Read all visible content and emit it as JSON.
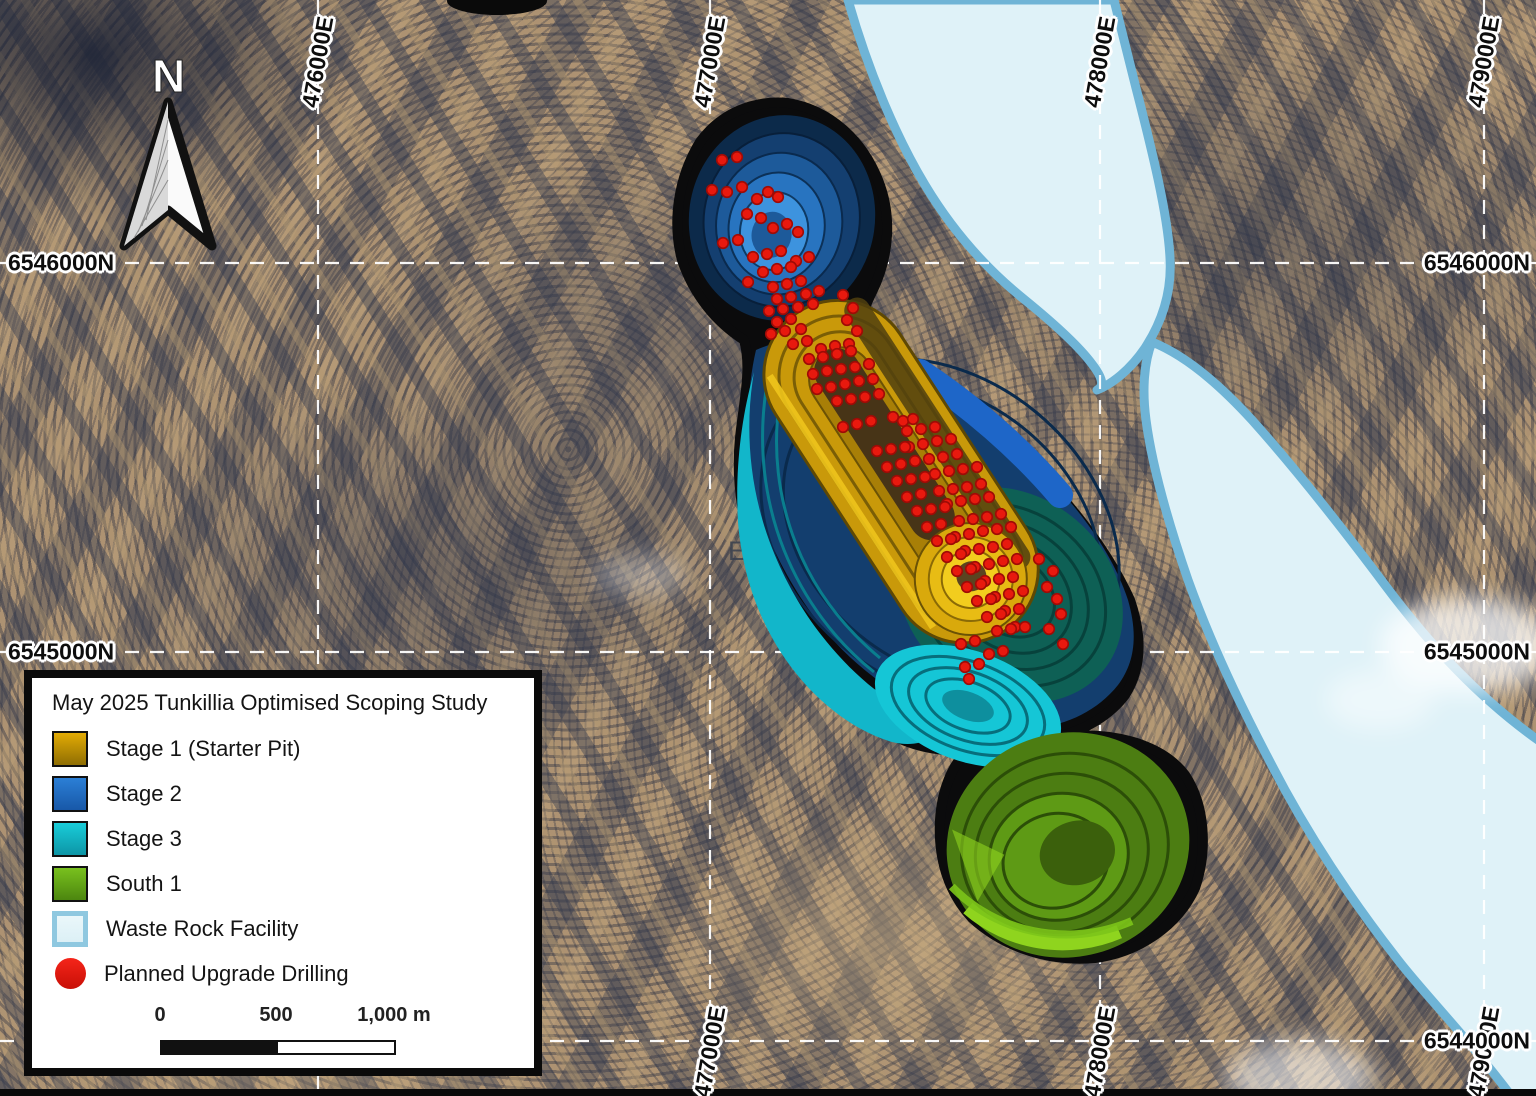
{
  "map": {
    "north_arrow_label": "N",
    "tenement_label": "EL 590",
    "grid": {
      "eastings": [
        {
          "label": "476000E",
          "x": 318,
          "top": true,
          "bottom": false
        },
        {
          "label": "477000E",
          "x": 710,
          "top": true,
          "bottom": true
        },
        {
          "label": "478000E",
          "x": 1100,
          "top": true,
          "bottom": true
        },
        {
          "label": "479000E",
          "x": 1484,
          "top": true,
          "bottom": true
        }
      ],
      "northings": [
        {
          "label": "6546000N",
          "y": 263,
          "left": true,
          "right": true
        },
        {
          "label": "6545000N",
          "y": 652,
          "left": true,
          "right": true
        },
        {
          "label": "6544000N",
          "y": 1041,
          "left": false,
          "right": true
        }
      ]
    },
    "colors": {
      "grid_line": "#FFFFFF",
      "outline": "#0B0B0C",
      "stage1": "#C9990A",
      "stage1_floor": "#473417",
      "stage1_bright": "#F2CD1E",
      "stage2": "#133E6E",
      "stage2_bright": "#3D93DE",
      "stage3": "#13C4D4",
      "stage3_dark": "#0E6055",
      "south1": "#4C7D12",
      "south1_bright": "#8FD41E",
      "wrf_fill": "#DFF2F8",
      "wrf_border": "#6FB4D6",
      "drill": "#E8190E",
      "drill_edge": "#9E0B06"
    },
    "drill_points": [
      [
        722,
        160
      ],
      [
        737,
        157
      ],
      [
        712,
        190
      ],
      [
        727,
        192
      ],
      [
        742,
        187
      ],
      [
        757,
        199
      ],
      [
        768,
        192
      ],
      [
        778,
        197
      ],
      [
        747,
        214
      ],
      [
        761,
        218
      ],
      [
        723,
        243
      ],
      [
        738,
        240
      ],
      [
        773,
        228
      ],
      [
        787,
        224
      ],
      [
        798,
        232
      ],
      [
        753,
        257
      ],
      [
        767,
        254
      ],
      [
        781,
        251
      ],
      [
        796,
        261
      ],
      [
        809,
        257
      ],
      [
        763,
        272
      ],
      [
        777,
        269
      ],
      [
        791,
        267
      ],
      [
        748,
        282
      ],
      [
        773,
        287
      ],
      [
        787,
        284
      ],
      [
        801,
        281
      ],
      [
        777,
        299
      ],
      [
        791,
        297
      ],
      [
        806,
        294
      ],
      [
        819,
        291
      ],
      [
        769,
        311
      ],
      [
        783,
        309
      ],
      [
        798,
        307
      ],
      [
        813,
        304
      ],
      [
        777,
        322
      ],
      [
        791,
        319
      ],
      [
        843,
        295
      ],
      [
        853,
        308
      ],
      [
        847,
        320
      ],
      [
        857,
        331
      ],
      [
        771,
        334
      ],
      [
        785,
        331
      ],
      [
        801,
        329
      ],
      [
        793,
        344
      ],
      [
        807,
        341
      ],
      [
        821,
        349
      ],
      [
        835,
        346
      ],
      [
        849,
        344
      ],
      [
        809,
        359
      ],
      [
        823,
        357
      ],
      [
        837,
        354
      ],
      [
        851,
        351
      ],
      [
        813,
        374
      ],
      [
        827,
        371
      ],
      [
        841,
        369
      ],
      [
        855,
        367
      ],
      [
        869,
        364
      ],
      [
        817,
        389
      ],
      [
        831,
        387
      ],
      [
        845,
        384
      ],
      [
        859,
        381
      ],
      [
        873,
        379
      ],
      [
        837,
        401
      ],
      [
        851,
        399
      ],
      [
        865,
        397
      ],
      [
        879,
        394
      ],
      [
        893,
        417
      ],
      [
        903,
        421
      ],
      [
        913,
        419
      ],
      [
        907,
        431
      ],
      [
        921,
        429
      ],
      [
        935,
        427
      ],
      [
        843,
        427
      ],
      [
        857,
        424
      ],
      [
        871,
        421
      ],
      [
        909,
        447
      ],
      [
        923,
        444
      ],
      [
        937,
        441
      ],
      [
        951,
        439
      ],
      [
        877,
        451
      ],
      [
        891,
        449
      ],
      [
        905,
        447
      ],
      [
        929,
        459
      ],
      [
        943,
        457
      ],
      [
        957,
        454
      ],
      [
        887,
        467
      ],
      [
        901,
        464
      ],
      [
        915,
        461
      ],
      [
        935,
        474
      ],
      [
        949,
        471
      ],
      [
        963,
        469
      ],
      [
        977,
        467
      ],
      [
        897,
        481
      ],
      [
        911,
        479
      ],
      [
        925,
        477
      ],
      [
        939,
        491
      ],
      [
        953,
        489
      ],
      [
        967,
        487
      ],
      [
        981,
        484
      ],
      [
        907,
        497
      ],
      [
        921,
        494
      ],
      [
        947,
        504
      ],
      [
        961,
        501
      ],
      [
        975,
        499
      ],
      [
        989,
        497
      ],
      [
        917,
        511
      ],
      [
        931,
        509
      ],
      [
        945,
        507
      ],
      [
        959,
        521
      ],
      [
        973,
        519
      ],
      [
        987,
        517
      ],
      [
        1001,
        514
      ],
      [
        927,
        527
      ],
      [
        941,
        524
      ],
      [
        955,
        537
      ],
      [
        969,
        534
      ],
      [
        983,
        531
      ],
      [
        997,
        529
      ],
      [
        1011,
        527
      ],
      [
        937,
        541
      ],
      [
        951,
        539
      ],
      [
        965,
        551
      ],
      [
        979,
        549
      ],
      [
        993,
        547
      ],
      [
        1007,
        544
      ],
      [
        947,
        557
      ],
      [
        961,
        554
      ],
      [
        975,
        567
      ],
      [
        989,
        564
      ],
      [
        1003,
        561
      ],
      [
        1017,
        559
      ],
      [
        957,
        571
      ],
      [
        971,
        569
      ],
      [
        985,
        581
      ],
      [
        999,
        579
      ],
      [
        1013,
        577
      ],
      [
        967,
        587
      ],
      [
        981,
        584
      ],
      [
        995,
        597
      ],
      [
        1009,
        594
      ],
      [
        1023,
        591
      ],
      [
        977,
        601
      ],
      [
        991,
        599
      ],
      [
        1005,
        611
      ],
      [
        1019,
        609
      ],
      [
        987,
        617
      ],
      [
        1001,
        614
      ],
      [
        1015,
        627
      ],
      [
        997,
        631
      ],
      [
        1011,
        629
      ],
      [
        1025,
        627
      ],
      [
        1039,
        559
      ],
      [
        1053,
        571
      ],
      [
        1047,
        587
      ],
      [
        1057,
        599
      ],
      [
        1061,
        614
      ],
      [
        1049,
        629
      ],
      [
        1063,
        644
      ],
      [
        961,
        644
      ],
      [
        975,
        641
      ],
      [
        989,
        654
      ],
      [
        1003,
        651
      ],
      [
        965,
        667
      ],
      [
        979,
        664
      ],
      [
        969,
        679
      ]
    ]
  },
  "legend": {
    "title": "May 2025 Tunkillia Optimised Scoping Study",
    "items": [
      {
        "id": "stage1",
        "label": "Stage 1 (Starter Pit)",
        "type": "square",
        "fill_top": "#E2AB04",
        "fill_bottom": "#8F6E03"
      },
      {
        "id": "stage2",
        "label": "Stage 2",
        "type": "square",
        "fill_top": "#2B7FD6",
        "fill_bottom": "#1858A8"
      },
      {
        "id": "stage3",
        "label": "Stage 3",
        "type": "square",
        "fill_top": "#19CDD9",
        "fill_bottom": "#0D95A6"
      },
      {
        "id": "south1",
        "label": "South 1",
        "type": "square",
        "fill_top": "#79C11E",
        "fill_bottom": "#4C860F"
      },
      {
        "id": "wrf",
        "label": "Waste Rock Facility",
        "type": "square",
        "fill_top": "#EAF7FA",
        "fill_bottom": "#DCF0F6",
        "border": "#8FC8E0"
      },
      {
        "id": "drilling",
        "label": "Planned Upgrade Drilling",
        "type": "circle",
        "fill_top": "#F5251A",
        "fill_bottom": "#C80F06"
      }
    ],
    "scale_bar": {
      "tick_labels": [
        "0",
        "500",
        "1,000 m"
      ]
    }
  }
}
